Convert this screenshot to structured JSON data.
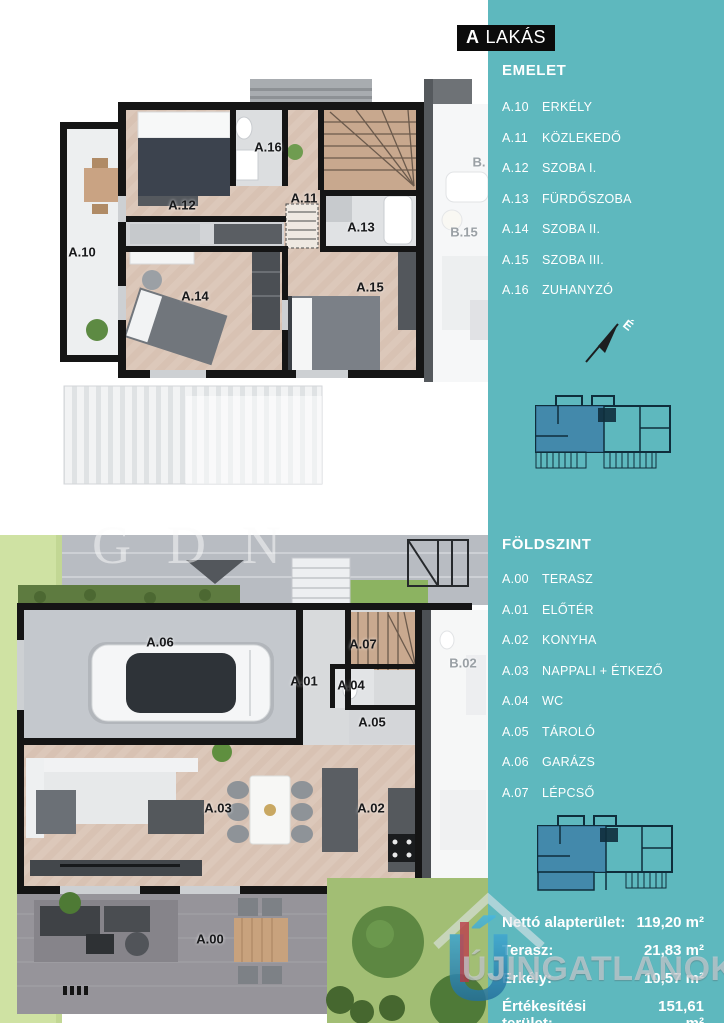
{
  "header": {
    "unit_letter": "A",
    "unit_word": "LAKÁS"
  },
  "colors": {
    "accent": "#5eb8be",
    "miniplanHighlight": "#3e80a8",
    "wallBlack": "#151515",
    "woodFloor": "#d8c2b3",
    "lawnGreen": "#cfe2a3"
  },
  "sidebar": {
    "compass_label": "É",
    "upper": {
      "title": "EMELET",
      "items": [
        {
          "code": "A.10",
          "label": "ERKÉLY"
        },
        {
          "code": "A.11",
          "label": "KÖZLEKEDŐ"
        },
        {
          "code": "A.12",
          "label": "SZOBA I."
        },
        {
          "code": "A.13",
          "label": "FÜRDŐSZOBA"
        },
        {
          "code": "A.14",
          "label": "SZOBA II."
        },
        {
          "code": "A.15",
          "label": "SZOBA III."
        },
        {
          "code": "A.16",
          "label": "ZUHANYZÓ"
        }
      ]
    },
    "ground": {
      "title": "FÖLDSZINT",
      "items": [
        {
          "code": "A.00",
          "label": "TERASZ"
        },
        {
          "code": "A.01",
          "label": "ELŐTÉR"
        },
        {
          "code": "A.02",
          "label": "KONYHA"
        },
        {
          "code": "A.03",
          "label": "NAPPALI + ÉTKEZŐ"
        },
        {
          "code": "A.04",
          "label": "WC"
        },
        {
          "code": "A.05",
          "label": "TÁROLÓ"
        },
        {
          "code": "A.06",
          "label": "GARÁZS"
        },
        {
          "code": "A.07",
          "label": "LÉPCSŐ"
        }
      ]
    },
    "stats": [
      {
        "label": "Nettó alapterület:",
        "value": "119,20 m²"
      },
      {
        "label": "Terasz:",
        "value": "21,83 m²"
      },
      {
        "label": "Erkély:",
        "value": "10,57 m²"
      },
      {
        "label": "Értékesítési terület:",
        "value": "151,61 m²"
      }
    ]
  },
  "plan_upper": {
    "labels": [
      "A.10",
      "A.12",
      "A.16",
      "A.11",
      "A.13",
      "A.14",
      "A.15"
    ],
    "neighbors": [
      "B.",
      "B.15"
    ]
  },
  "plan_ground": {
    "labels": [
      "A.06",
      "A.07",
      "A.01",
      "A.04",
      "A.05",
      "A.03",
      "A.02",
      "A.00"
    ],
    "neighbors": [
      "B.02"
    ]
  },
  "watermarks": {
    "gdn": "GDN",
    "site": "ÚJINGATLANOK.HU",
    "site_logo_letter": "Ú"
  }
}
